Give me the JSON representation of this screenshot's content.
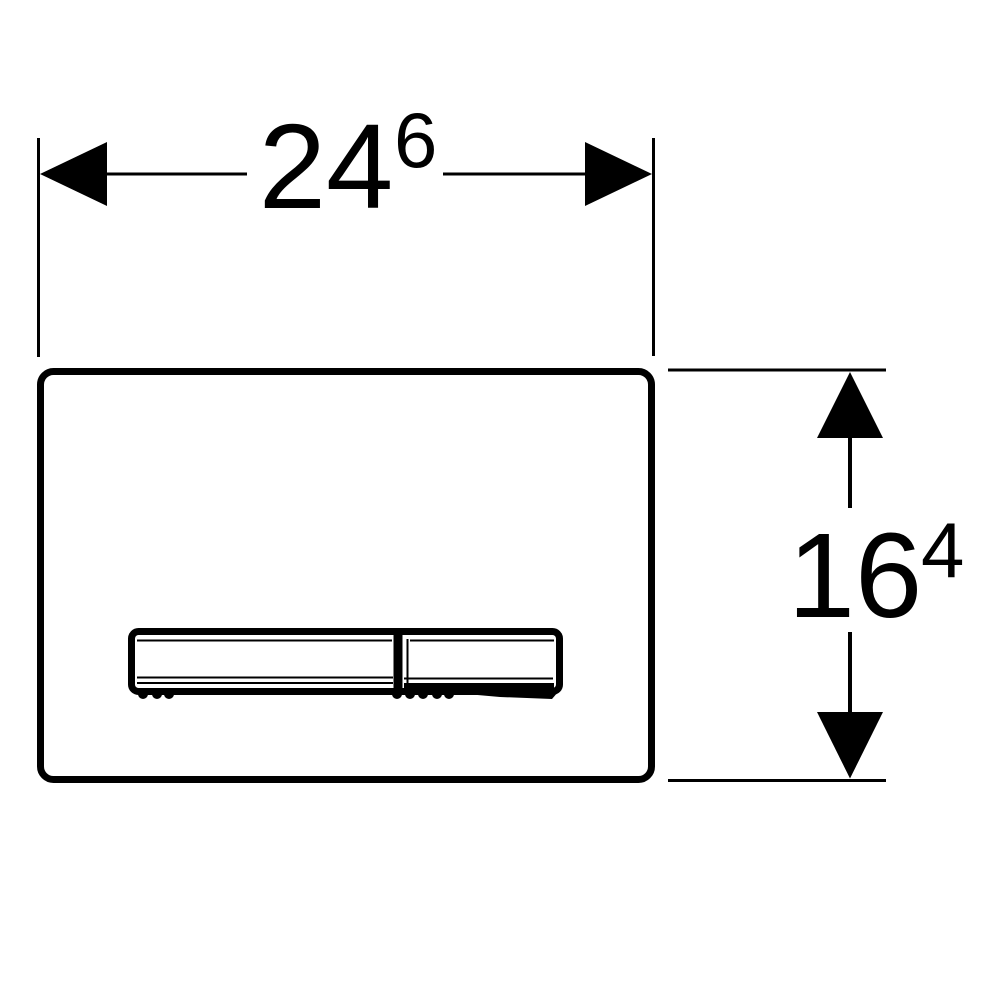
{
  "drawing": {
    "type": "technical-dimension-drawing",
    "background_color": "#ffffff",
    "line_color": "#000000",
    "width_dimension": {
      "value": "24",
      "superscript": "6"
    },
    "height_dimension": {
      "value": "16",
      "superscript": "4"
    },
    "icons": {
      "arrow_left": "filled-triangle-left",
      "arrow_right": "filled-triangle-right",
      "arrow_up": "filled-triangle-up",
      "arrow_down": "filled-triangle-down"
    }
  }
}
